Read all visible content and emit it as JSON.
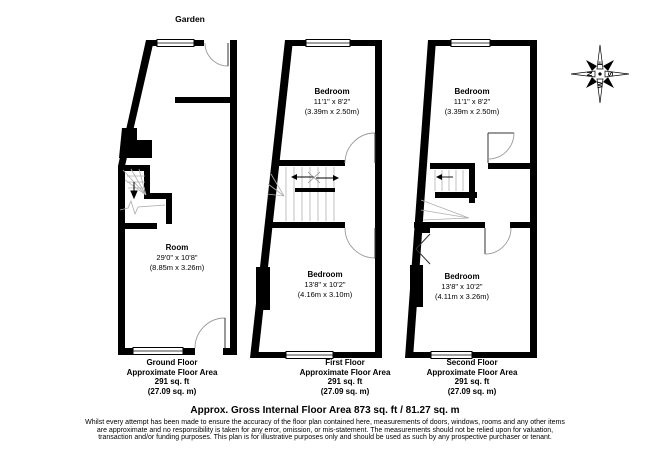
{
  "garden_label": "Garden",
  "compass": {
    "n": "N",
    "e": "E",
    "s": "S",
    "w": "W"
  },
  "floors": [
    {
      "name": "Ground Floor",
      "area_label": "Approximate Floor Area",
      "area_ft": "291 sq. ft",
      "area_m": "(27.09 sq. m)",
      "rooms": [
        {
          "name": "Room",
          "imperial": "29'0\" x 10'8\"",
          "metric": "(8.85m x 3.26m)"
        }
      ]
    },
    {
      "name": "First Floor",
      "area_label": "Approximate Floor Area",
      "area_ft": "291 sq. ft",
      "area_m": "(27.09 sq. m)",
      "rooms": [
        {
          "name": "Bedroom",
          "imperial": "11'1\" x 8'2\"",
          "metric": "(3.39m x 2.50m)"
        },
        {
          "name": "Bedroom",
          "imperial": "13'8\" x 10'2\"",
          "metric": "(4.16m x 3.10m)"
        }
      ]
    },
    {
      "name": "Second Floor",
      "area_label": "Approximate Floor Area",
      "area_ft": "291 sq. ft",
      "area_m": "(27.09 sq. m)",
      "rooms": [
        {
          "name": "Bedroom",
          "imperial": "11'1\" x 8'2\"",
          "metric": "(3.39m x 2.50m)"
        },
        {
          "name": "Bedroom",
          "imperial": "13'8\" x 10'2\"",
          "metric": "(4.11m x 3.26m)"
        }
      ]
    }
  ],
  "summary": {
    "title": "Approx. Gross Internal Floor Area 873 sq. ft / 81.27 sq. m",
    "disclaimer": "Whilst every attempt has been made to ensure the accuracy of the floor plan contained here, measurements of doors, windows, rooms and any other items are approximate and no responsibility is taken for any error, omission, or mis-statement. The measurements should not be relied upon for valuation, transaction and/or funding purposes. This plan is for illustrative purposes only and should be used as such by any prospective purchaser or tenant."
  }
}
